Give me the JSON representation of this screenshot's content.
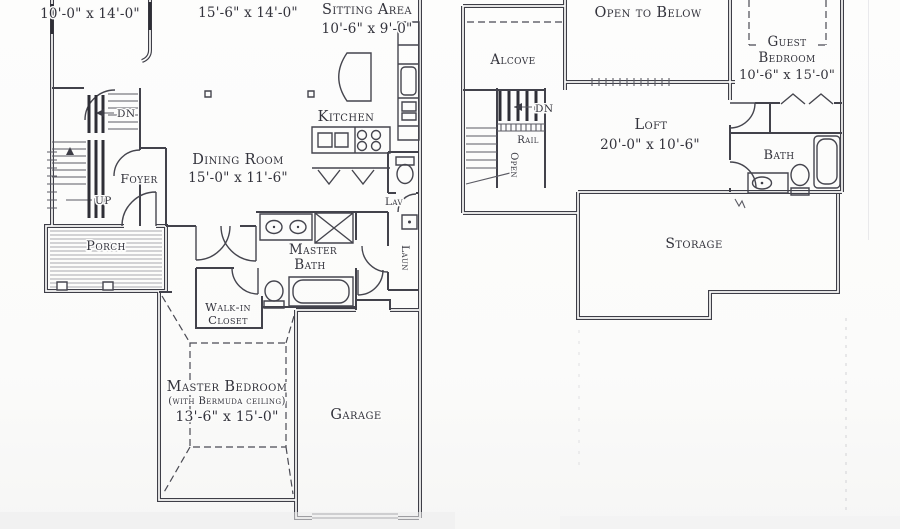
{
  "palette": {
    "ink": "#3c3c45",
    "paper": "#fcfcfb"
  },
  "first_floor": {
    "upper_left_room_dims": "10'-0\" x 14'-0\"",
    "great_room_dims": "15'-6\" x 14'-0\"",
    "sitting_area": {
      "name": "Sitting Area",
      "dims": "10'-6\" x 9'-0\""
    },
    "kitchen": {
      "name": "Kitchen"
    },
    "dining_room": {
      "name": "Dining Room",
      "dims": "15'-0\" x 11'-6\""
    },
    "foyer": {
      "name": "Foyer"
    },
    "stairs": {
      "up": "UP",
      "down": "DN"
    },
    "porch": {
      "name": "Porch"
    },
    "lav": {
      "name": "Lav"
    },
    "laundry": {
      "name": "Laun"
    },
    "master_bath": {
      "line1": "Master",
      "line2": "Bath"
    },
    "walk_in_closet": {
      "line1": "Walk-in",
      "line2": "Closet"
    },
    "master_bedroom": {
      "name": "Master Bedroom",
      "note": "(with Bermuda ceiling)",
      "dims": "13'-6\" x 15'-0\""
    },
    "garage": {
      "name": "Garage"
    }
  },
  "second_floor": {
    "open_to_below": {
      "name": "Open to Below"
    },
    "alcove": {
      "name": "Alcove"
    },
    "guest_bedroom": {
      "line1": "Guest",
      "line2": "Bedroom",
      "dims": "10'-6\" x 15'-0\""
    },
    "stairs": {
      "down": "DN",
      "rail": "Rail",
      "open": "Open"
    },
    "loft": {
      "name": "Loft",
      "dims": "20'-0\" x 10'-6\""
    },
    "bath": {
      "name": "Bath"
    },
    "storage": {
      "name": "Storage"
    }
  }
}
